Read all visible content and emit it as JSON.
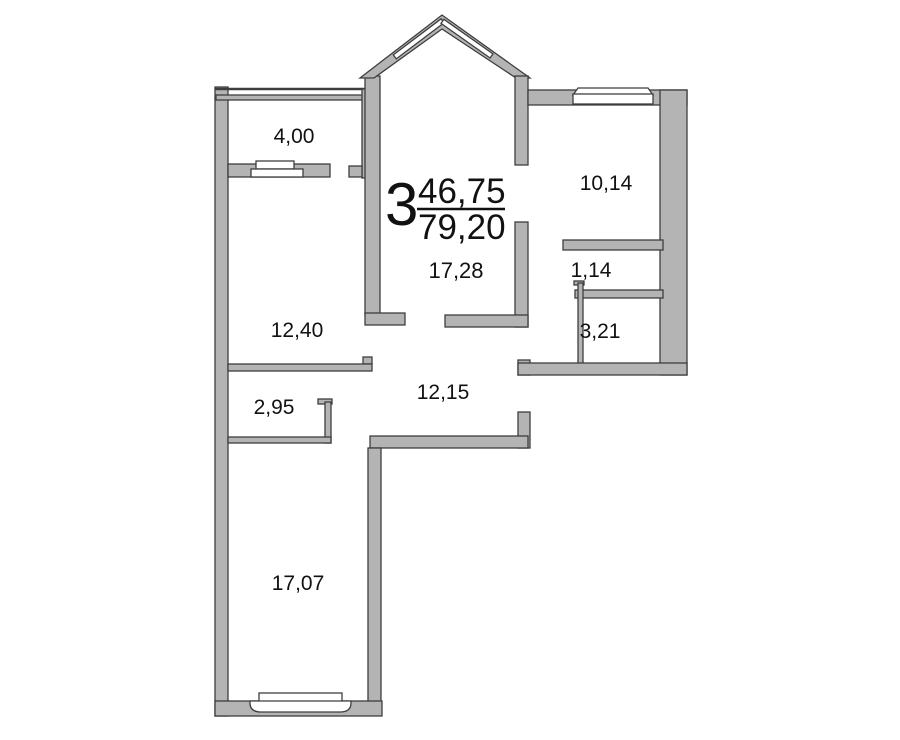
{
  "plan": {
    "summary": {
      "rooms_count": "3",
      "living_area": "46,75",
      "total_area": "79,20"
    },
    "rooms": {
      "living_room": {
        "area": "17,28"
      },
      "balcony": {
        "area": "4,00"
      },
      "bedroom_top_right": {
        "area": "10,14"
      },
      "bedroom_left": {
        "area": "12,40"
      },
      "storage": {
        "area": "1,14"
      },
      "bathroom": {
        "area": "3,21"
      },
      "closet": {
        "area": "2,95"
      },
      "hallway": {
        "area": "12,15"
      },
      "bedroom_bottom": {
        "area": "17,07"
      }
    },
    "colors": {
      "wall_fill": "#b4b4b4",
      "wall_stroke": "#3e3e3e",
      "text": "#111111",
      "background": "#ffffff"
    }
  }
}
